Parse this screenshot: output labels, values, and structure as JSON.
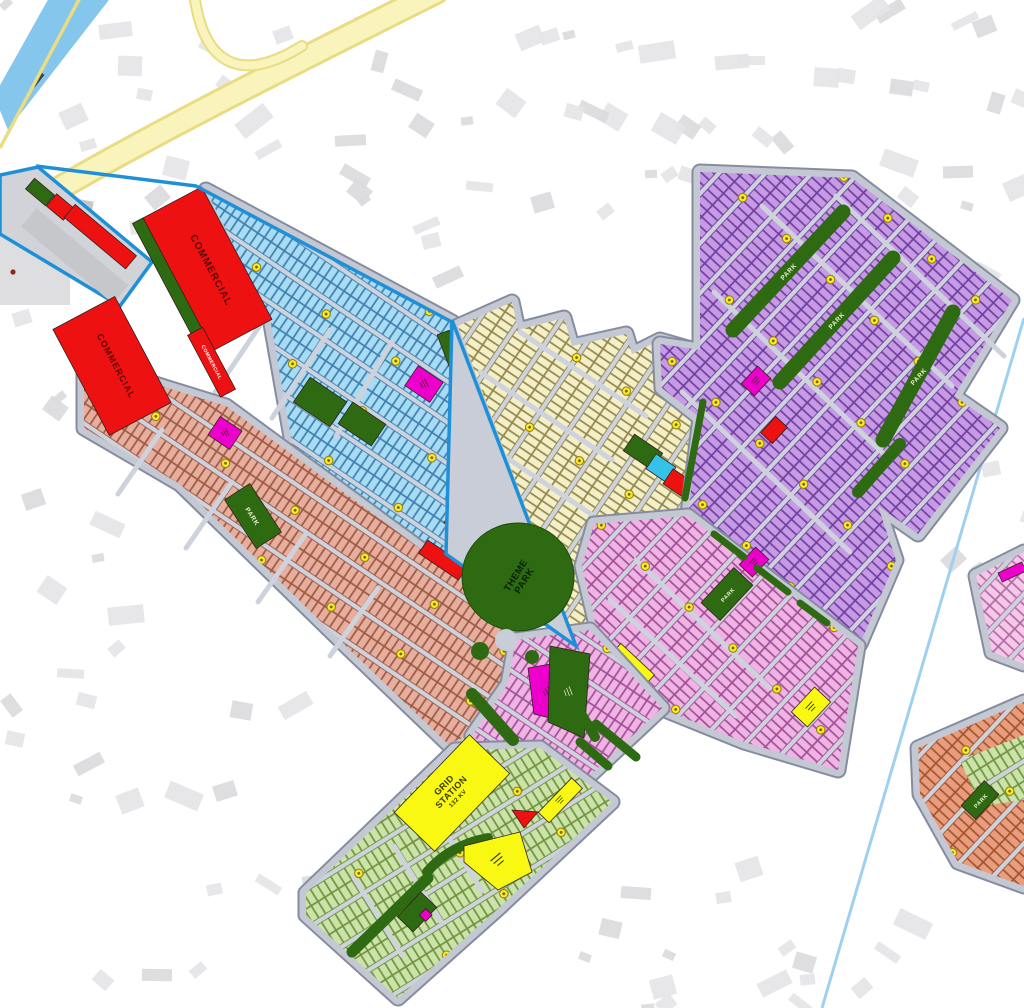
{
  "map": {
    "type": "housing-scheme-master-plan-overlay",
    "description": "Colored society master plan overlaid on faint street map background",
    "labels": {
      "commercial": "COMMERCIAL",
      "park": "PARK",
      "theme_park_1": "THEME",
      "theme_park_2": "PARK",
      "grid_1": "GRID",
      "grid_2": "STATION",
      "grid_3": "132 KV"
    },
    "zones": [
      {
        "name": "commercial-block-north",
        "label": "COMMERCIAL",
        "color": "#ee1111"
      },
      {
        "name": "commercial-block-west",
        "label": "COMMERCIAL",
        "color": "#ee1111"
      },
      {
        "name": "commercial-strip",
        "label": "COMMERCIAL",
        "color": "#ee1111"
      },
      {
        "name": "commercial-strip-south",
        "label": "COMMERCIAL",
        "color": "#ee1111"
      },
      {
        "name": "residential-cyan",
        "color": "#a8dcf5"
      },
      {
        "name": "residential-salmon",
        "color": "#e7ae9d"
      },
      {
        "name": "residential-cream",
        "color": "#f5efc8"
      },
      {
        "name": "residential-purple",
        "color": "#c79ae6"
      },
      {
        "name": "residential-pink",
        "color": "#f0b4e4"
      },
      {
        "name": "residential-lilac-wing",
        "color": "#f0b4e4"
      },
      {
        "name": "residential-green-wing",
        "color": "#cbe3a9"
      },
      {
        "name": "sector-southeast",
        "color": "#e99d7c"
      },
      {
        "name": "sector-east-pink",
        "color": "#f6c8e8"
      },
      {
        "name": "theme-park",
        "label": "THEME PARK",
        "color": "#2d6a12"
      },
      {
        "name": "grid-station",
        "label": "GRID STATION 132 KV",
        "color": "#f8f813"
      },
      {
        "name": "park-strips",
        "label": "PARK",
        "color": "#2d6a12"
      }
    ],
    "palette": {
      "red": "#ee1111",
      "darkgreen": "#2d6a12",
      "yellow": "#f8f813",
      "magenta": "#ee00cc",
      "cyanplot": "#a8dcf5",
      "salmonplot": "#e7ae9d",
      "creamplot": "#f5efc8",
      "purpleplot": "#c79ae6",
      "pinkplot": "#f0b4e4",
      "pinklightplot": "#f6c8e8",
      "greenplot": "#cbe3a9",
      "orangeplot": "#e99d7c",
      "roadbase": "#c4c8d3",
      "streets": "#ced2dc",
      "roadline": "#868ca0",
      "blueline": "#1e90d8",
      "canal": "#85c6ec",
      "thinblue": "#9fd0f0",
      "highway": "#f8f4bc",
      "highwayedge": "#e9dc82",
      "dot": "#ffe92c",
      "bg": "#ffffff"
    }
  }
}
